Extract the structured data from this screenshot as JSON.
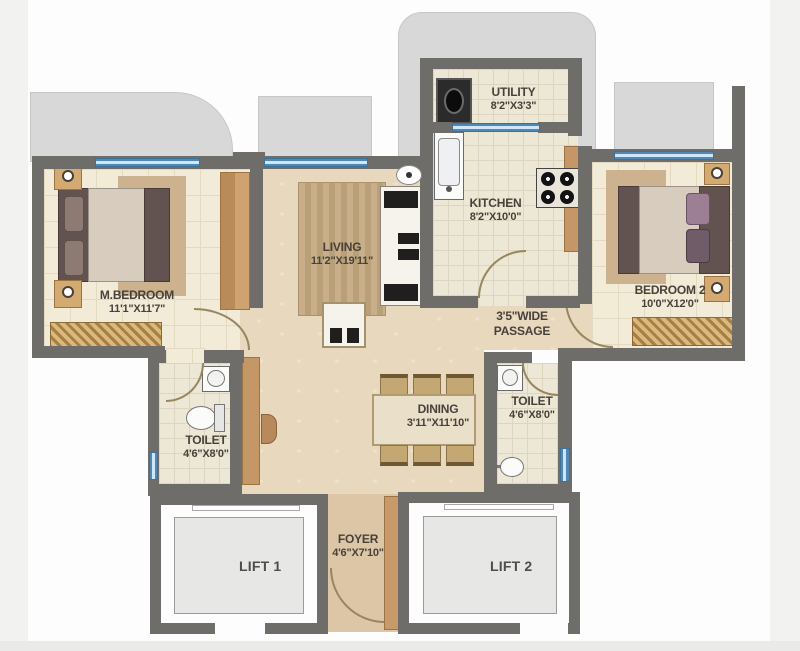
{
  "plan": {
    "type": "residential-floor-plan",
    "rooms": {
      "utility": {
        "name": "UTILITY",
        "dims": "8'2\"X3'3\""
      },
      "kitchen": {
        "name": "KITCHEN",
        "dims": "8'2\"X10'0\""
      },
      "living": {
        "name": "LIVING",
        "dims": "11'2\"X19'11\""
      },
      "m_bedroom": {
        "name": "M.BEDROOM",
        "dims": "11'1\"X11'7\""
      },
      "bedroom2": {
        "name": "BEDROOM 2",
        "dims": "10'0\"X12'0\""
      },
      "passage": {
        "line1": "3'5\"WIDE",
        "line2": "PASSAGE"
      },
      "dining": {
        "name": "DINING",
        "dims": "3'11\"X11'10\""
      },
      "toilet_left": {
        "name": "TOILET",
        "dims": "4'6\"X8'0\""
      },
      "toilet_right": {
        "name": "TOILET",
        "dims": "4'6\"X8'0\""
      },
      "foyer": {
        "name": "FOYER",
        "dims": "4'6\"X7'10\""
      },
      "lift1": {
        "name": "LIFT 1"
      },
      "lift2": {
        "name": "LIFT 2"
      }
    },
    "colors": {
      "wall": "#6f6d6a",
      "window_blue": "#6fb0de",
      "deck_gray": "#d8d8d8",
      "floor_beige": "#e8d8be",
      "floor_cream": "#f2ebd8",
      "wood_brown": "#c59767",
      "label_text": "#47413a"
    }
  }
}
